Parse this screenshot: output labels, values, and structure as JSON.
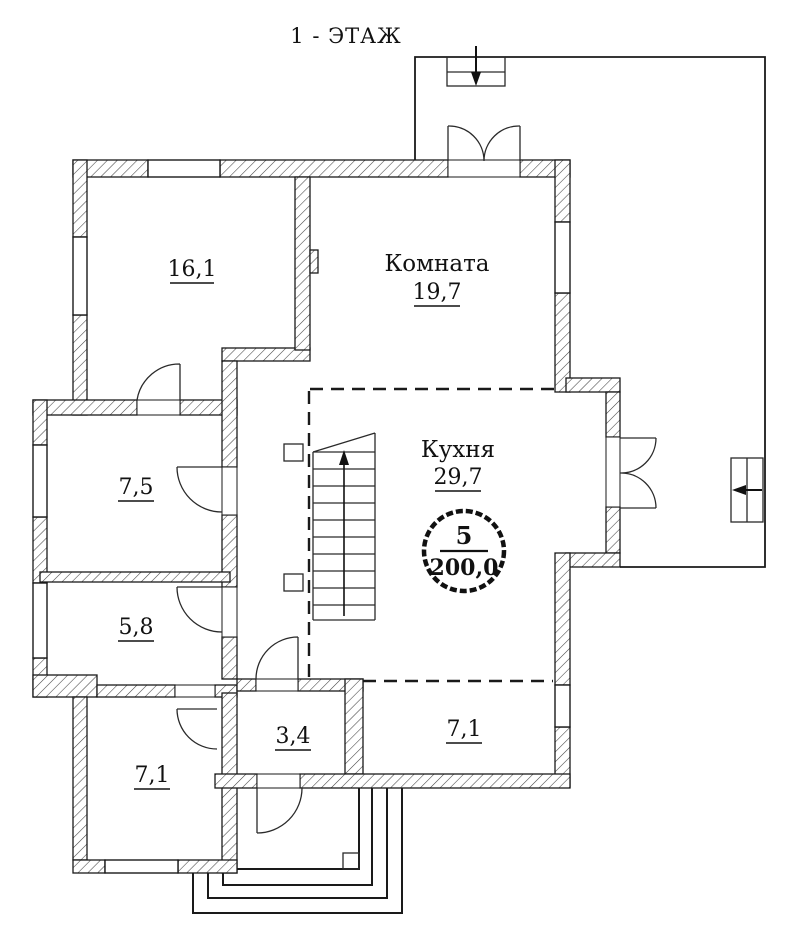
{
  "title": "1 - ЭТАЖ",
  "rooms": {
    "room_16_1": {
      "area": "16,1"
    },
    "komnata": {
      "name": "Комната",
      "area": "19,7"
    },
    "room_7_5": {
      "area": "7,5"
    },
    "kuhnya": {
      "name": "Кухня",
      "area": "29,7"
    },
    "room_5_8": {
      "area": "5,8"
    },
    "room_7_1_left": {
      "area": "7,1"
    },
    "room_3_4": {
      "area": "3,4"
    },
    "room_7_1_right": {
      "area": "7,1"
    }
  },
  "stamp": {
    "flat_number": "5",
    "total_area": "200,0"
  },
  "colors": {
    "ink": "#111111",
    "paper": "#ffffff"
  }
}
